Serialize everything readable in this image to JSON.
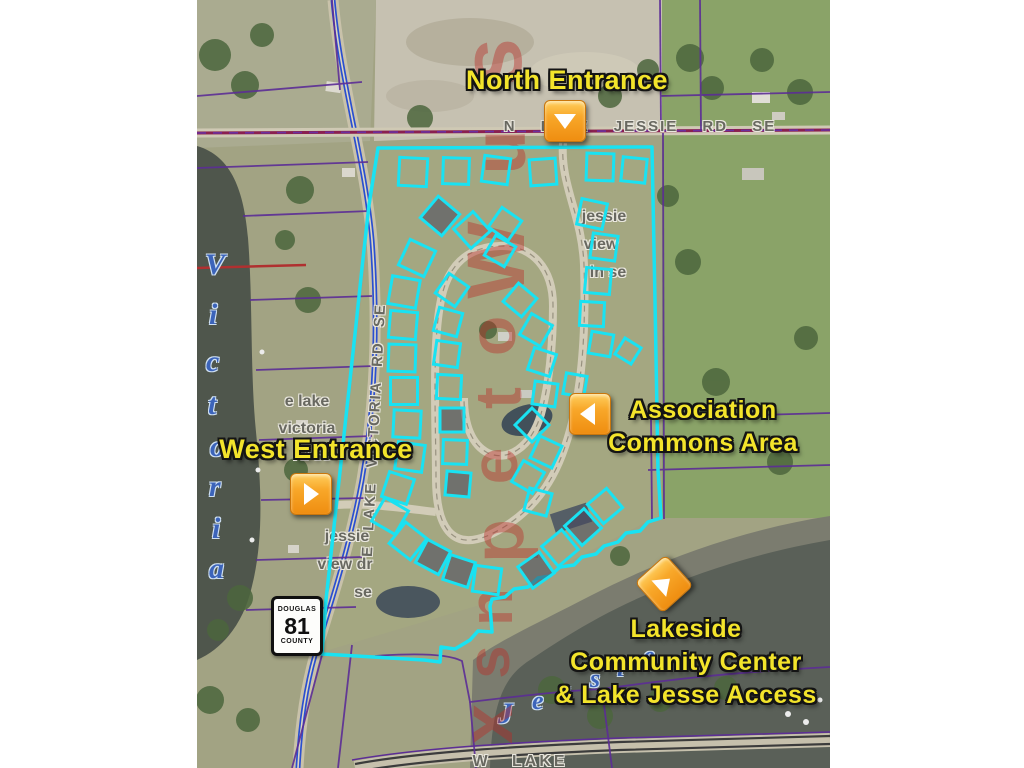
{
  "canvas": {
    "background": "#ffffff",
    "map_left": 197,
    "map_width": 633,
    "map_height": 768
  },
  "captions": {
    "north_entrance": "North Entrance",
    "west_entrance": "West Entrance",
    "association_line1": "Association",
    "association_line2": "Commons Area",
    "lakeside_line1": "Lakeside",
    "lakeside_line2": "Community Center",
    "lakeside_line3": "& Lake Jesse Access"
  },
  "roads": {
    "north_road": "N LAKE JESSIE RD SE",
    "west_road_vertical": "E LAKE VICTORIA RD SE",
    "west_road_small_line1": "e lake",
    "west_road_small_line2": "victoria",
    "west_road_small_line3": "rd se",
    "jessie_view_ln_line1": "jessie",
    "jessie_view_ln_line2": "view",
    "jessie_view_ln_line3": "ln se",
    "jessie_view_dr_line1": "jessie",
    "jessie_view_dr_line2": "view dr",
    "jessie_view_dr_line3": "se",
    "bottom_road": "W LAKE"
  },
  "lakes": {
    "victoria_name": "Victoria",
    "jessie_name": "Jessie",
    "victoria_letters": [
      {
        "ch": "V",
        "x": 205,
        "y": 248
      },
      {
        "ch": "i",
        "x": 209,
        "y": 298
      },
      {
        "ch": "c",
        "x": 206,
        "y": 345
      },
      {
        "ch": "t",
        "x": 208,
        "y": 388
      },
      {
        "ch": "o",
        "x": 210,
        "y": 430
      },
      {
        "ch": "r",
        "x": 209,
        "y": 470
      },
      {
        "ch": "i",
        "x": 212,
        "y": 512
      },
      {
        "ch": "a",
        "x": 209,
        "y": 552
      }
    ],
    "jessie_letters": [
      {
        "ch": "J",
        "x": 498,
        "y": 697,
        "size": 30
      },
      {
        "ch": "e",
        "x": 532,
        "y": 686,
        "size": 26
      },
      {
        "ch": "s",
        "x": 561,
        "y": 676,
        "size": 26
      },
      {
        "ch": "s",
        "x": 590,
        "y": 664,
        "size": 26
      },
      {
        "ch": "i",
        "x": 617,
        "y": 653,
        "size": 26
      },
      {
        "ch": "e",
        "x": 643,
        "y": 641,
        "size": 26
      }
    ]
  },
  "sign": {
    "top": "DOUGLAS",
    "number": "81",
    "bottom": "COUNTY"
  },
  "watermark": {
    "color": "#ba2c26",
    "glyphs": [
      {
        "ch": "s",
        "x": 492,
        "y": 62,
        "size": 86
      },
      {
        "ch": "u",
        "x": 500,
        "y": 152,
        "size": 74
      },
      {
        "ch": "W",
        "x": 497,
        "y": 260,
        "size": 82
      },
      {
        "ch": "o",
        "x": 492,
        "y": 336,
        "size": 66
      },
      {
        "ch": "t",
        "x": 498,
        "y": 398,
        "size": 66
      },
      {
        "ch": "e",
        "x": 494,
        "y": 466,
        "size": 66
      },
      {
        "ch": "p",
        "x": 499,
        "y": 541,
        "size": 72
      },
      {
        "ch": "n",
        "x": 492,
        "y": 607,
        "size": 62
      },
      {
        "ch": "s",
        "x": 489,
        "y": 662,
        "size": 60
      },
      {
        "ch": "x",
        "x": 488,
        "y": 724,
        "size": 72
      }
    ]
  },
  "markers": [
    {
      "name": "north-entrance-marker",
      "dir": "down",
      "x": 565,
      "y": 121,
      "rot": 0
    },
    {
      "name": "west-entrance-marker",
      "dir": "right",
      "x": 311,
      "y": 494,
      "rot": 0
    },
    {
      "name": "association-commons-marker",
      "dir": "left",
      "x": 590,
      "y": 414,
      "rot": 0
    },
    {
      "name": "lakeside-access-marker",
      "dir": "right",
      "x": 664,
      "y": 584,
      "rot": -42
    }
  ],
  "colors": {
    "lot_cyan": "#19e2f2",
    "marker_orange": "#f79d1e",
    "caption_yellow": "#f3e42b",
    "parcel_purple": "#5c2d96",
    "road_blue": "#2a4fd0",
    "road_maroon": "#8a2050",
    "road_label_gray": "#686860",
    "lake_letter_blue": "#3c64ba"
  },
  "lots": [
    [
      413,
      172,
      28,
      3,
      0
    ],
    [
      456,
      171,
      26,
      2,
      0
    ],
    [
      496,
      170,
      26,
      8,
      0
    ],
    [
      543,
      172,
      26,
      -4,
      0
    ],
    [
      600,
      167,
      27,
      2,
      0
    ],
    [
      634,
      170,
      24,
      6,
      0
    ],
    [
      592,
      214,
      26,
      12,
      0
    ],
    [
      604,
      247,
      25,
      8,
      0
    ],
    [
      598,
      281,
      25,
      5,
      0
    ],
    [
      592,
      314,
      24,
      3,
      0
    ],
    [
      601,
      344,
      22,
      10,
      0
    ],
    [
      628,
      351,
      19,
      32,
      0
    ],
    [
      505,
      224,
      24,
      35,
      0
    ],
    [
      472,
      230,
      26,
      48,
      0
    ],
    [
      440,
      216,
      28,
      40,
      1
    ],
    [
      417,
      258,
      28,
      25,
      0
    ],
    [
      404,
      292,
      28,
      10,
      0
    ],
    [
      403,
      325,
      27,
      5,
      0
    ],
    [
      402,
      358,
      27,
      2,
      0
    ],
    [
      404,
      391,
      27,
      0,
      0
    ],
    [
      407,
      424,
      27,
      3,
      0
    ],
    [
      410,
      457,
      27,
      8,
      0
    ],
    [
      398,
      488,
      26,
      18,
      0
    ],
    [
      390,
      516,
      27,
      30,
      0
    ],
    [
      408,
      541,
      27,
      38,
      0
    ],
    [
      433,
      557,
      26,
      28,
      1
    ],
    [
      459,
      571,
      26,
      18,
      1
    ],
    [
      487,
      580,
      26,
      8,
      0
    ],
    [
      536,
      570,
      26,
      -35,
      1
    ],
    [
      560,
      548,
      26,
      -40,
      0
    ],
    [
      583,
      527,
      26,
      -42,
      1
    ],
    [
      605,
      506,
      25,
      -40,
      0
    ],
    [
      452,
      290,
      24,
      35,
      0
    ],
    [
      448,
      322,
      24,
      15,
      0
    ],
    [
      447,
      354,
      24,
      8,
      0
    ],
    [
      449,
      387,
      24,
      3,
      0
    ],
    [
      452,
      420,
      24,
      0,
      1
    ],
    [
      455,
      452,
      24,
      2,
      0
    ],
    [
      458,
      484,
      24,
      5,
      1
    ],
    [
      520,
      300,
      24,
      40,
      0
    ],
    [
      536,
      330,
      24,
      30,
      0
    ],
    [
      542,
      362,
      23,
      18,
      0
    ],
    [
      545,
      394,
      23,
      8,
      0
    ],
    [
      532,
      425,
      24,
      45,
      0
    ],
    [
      546,
      452,
      24,
      25,
      0
    ],
    [
      528,
      477,
      24,
      30,
      0
    ],
    [
      538,
      502,
      23,
      15,
      0
    ],
    [
      500,
      251,
      23,
      30,
      0
    ],
    [
      575,
      385,
      21,
      10,
      0
    ]
  ]
}
